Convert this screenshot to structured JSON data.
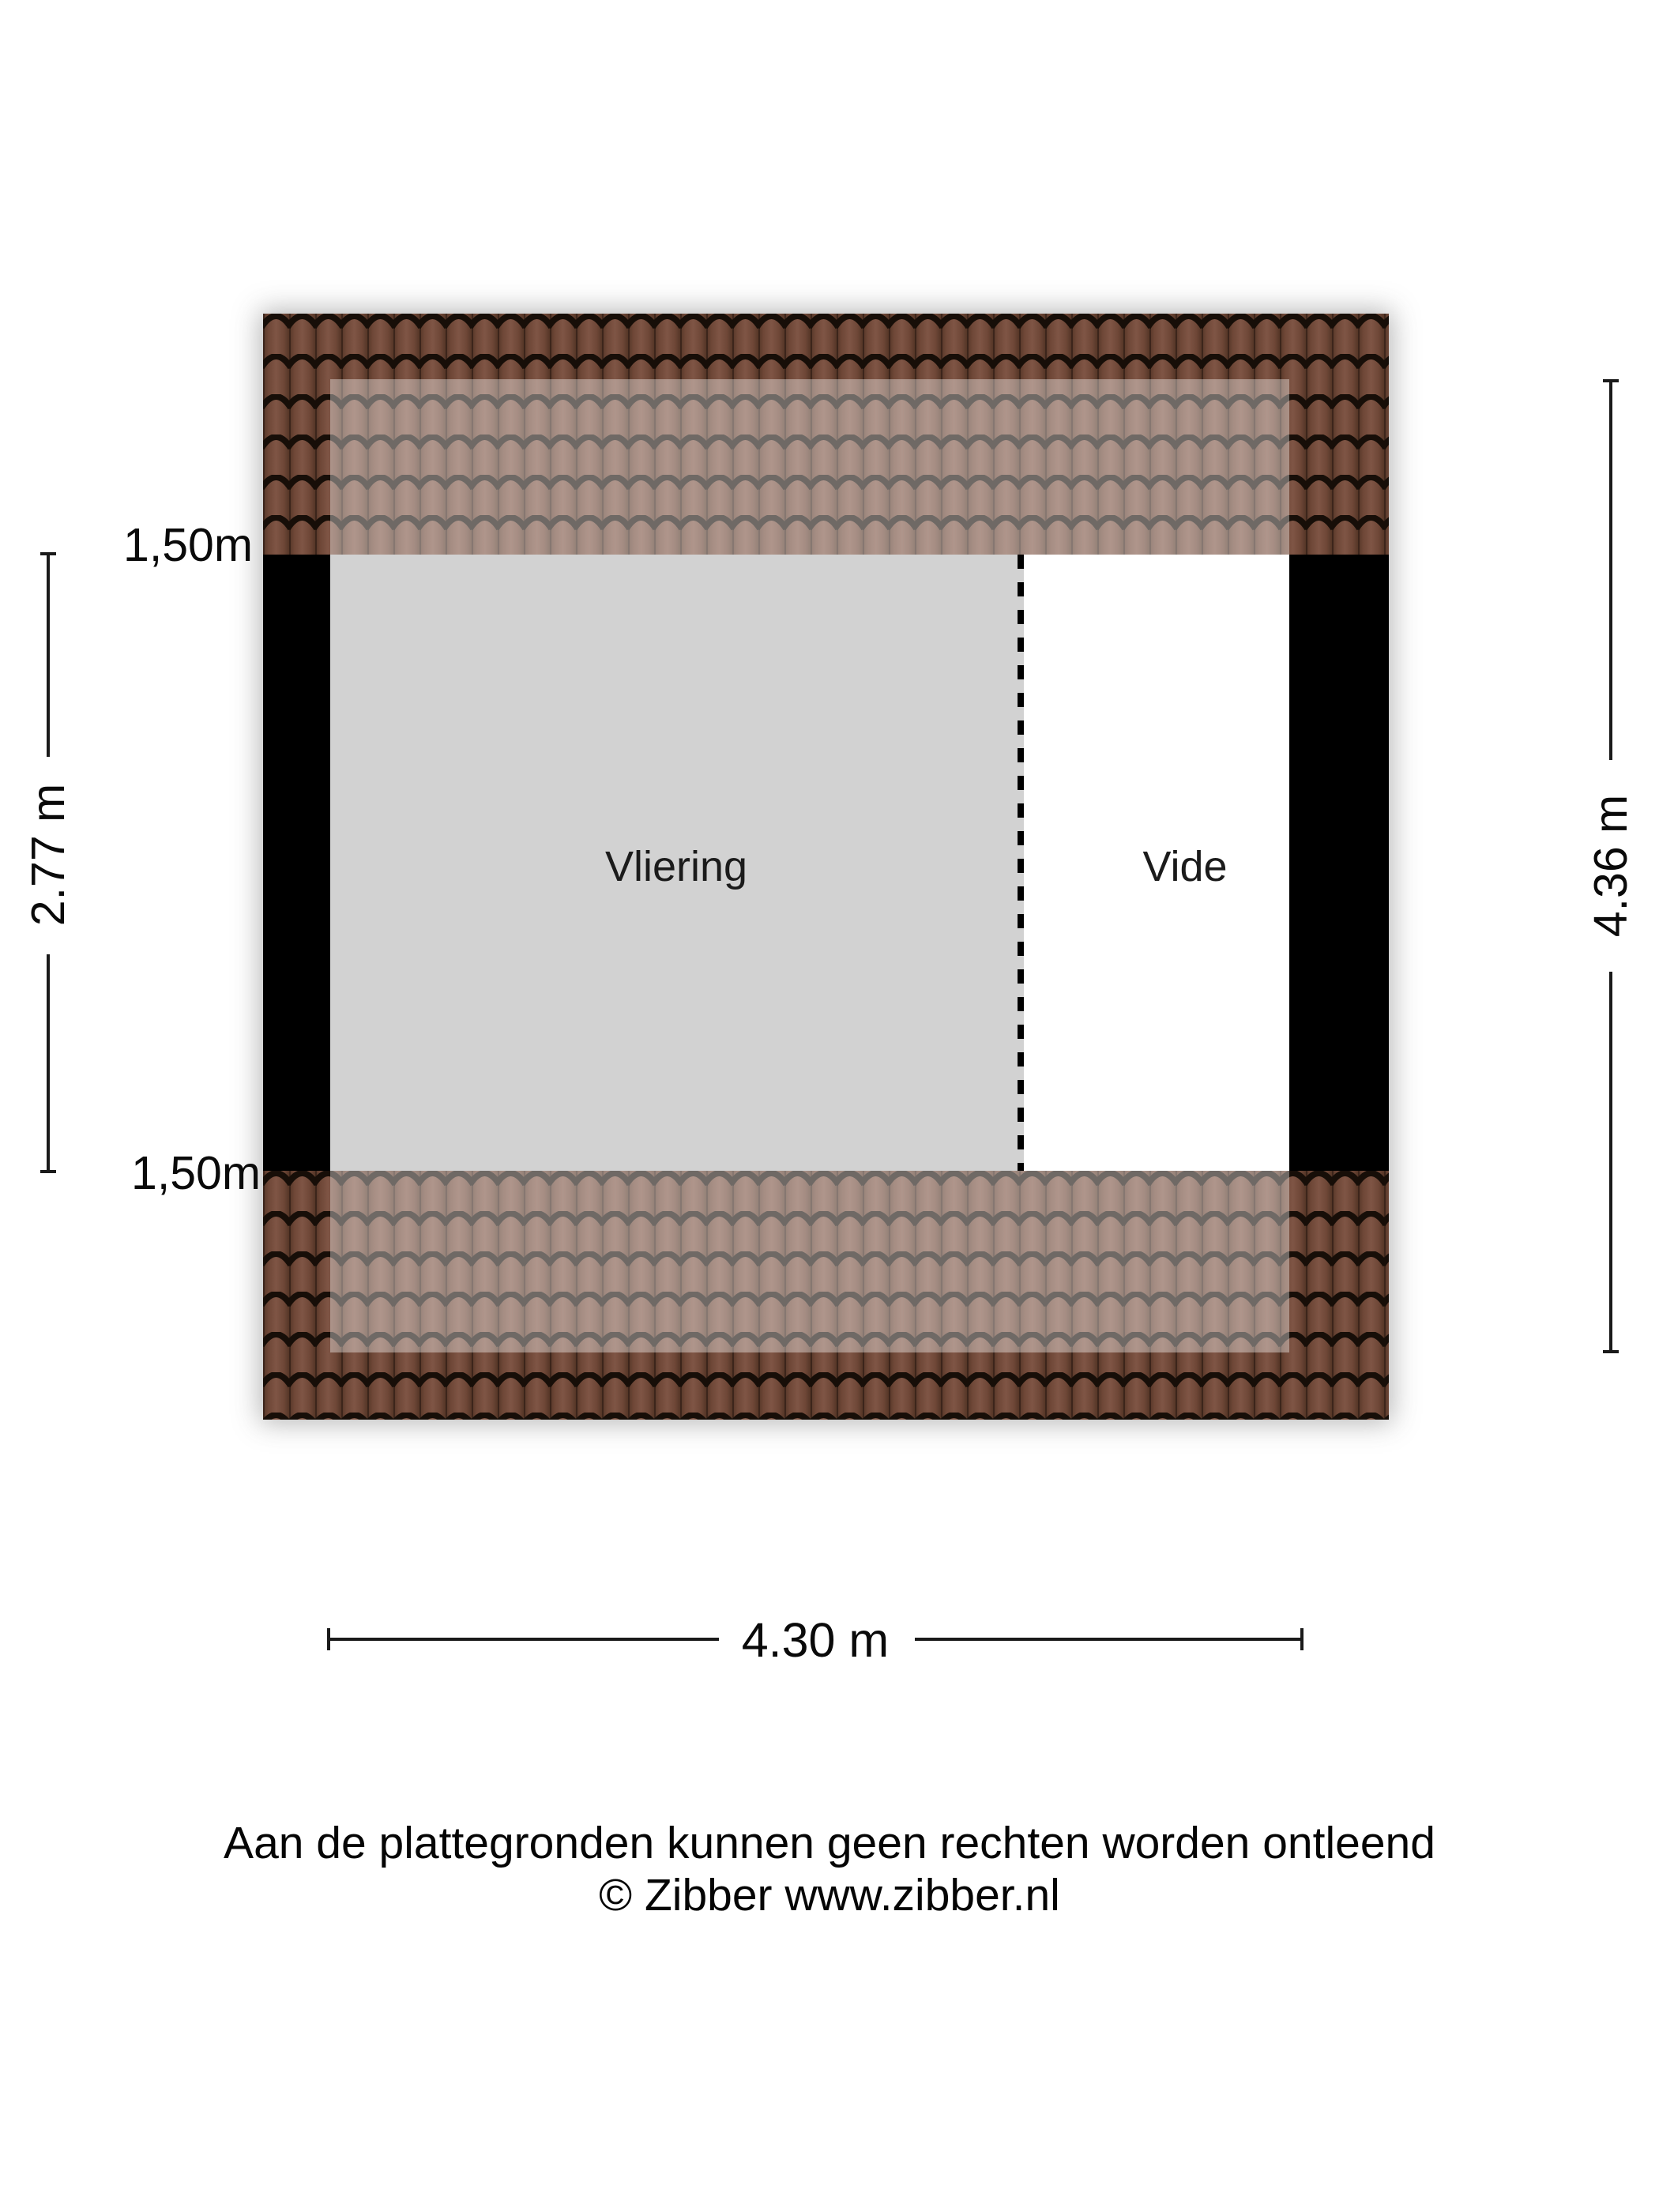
{
  "rooms": [
    {
      "label": "Vliering"
    },
    {
      "label": "Vide"
    }
  ],
  "dimensions": {
    "headroom_top_left": "1,50m",
    "headroom_bottom_left": "1,50m",
    "inner_depth": "2.77 m",
    "total_depth": "4.36 m",
    "total_width": "4.30 m"
  },
  "footer": {
    "disclaimer": "Aan de plattegronden kunnen geen rechten worden ontleend",
    "copyright": "© Zibber www.zibber.nl"
  },
  "colors": {
    "wall": "#000000",
    "room_vliering": "#d2d2d2",
    "room_vide": "#ffffff",
    "tile_base": "#6e4737",
    "tile_rib_light": "#7f5545",
    "tile_rib_dark": "#553627",
    "tile_seam": "#3c251b",
    "tile_line": "#170e08",
    "roof_overlay": "#ffffff"
  }
}
